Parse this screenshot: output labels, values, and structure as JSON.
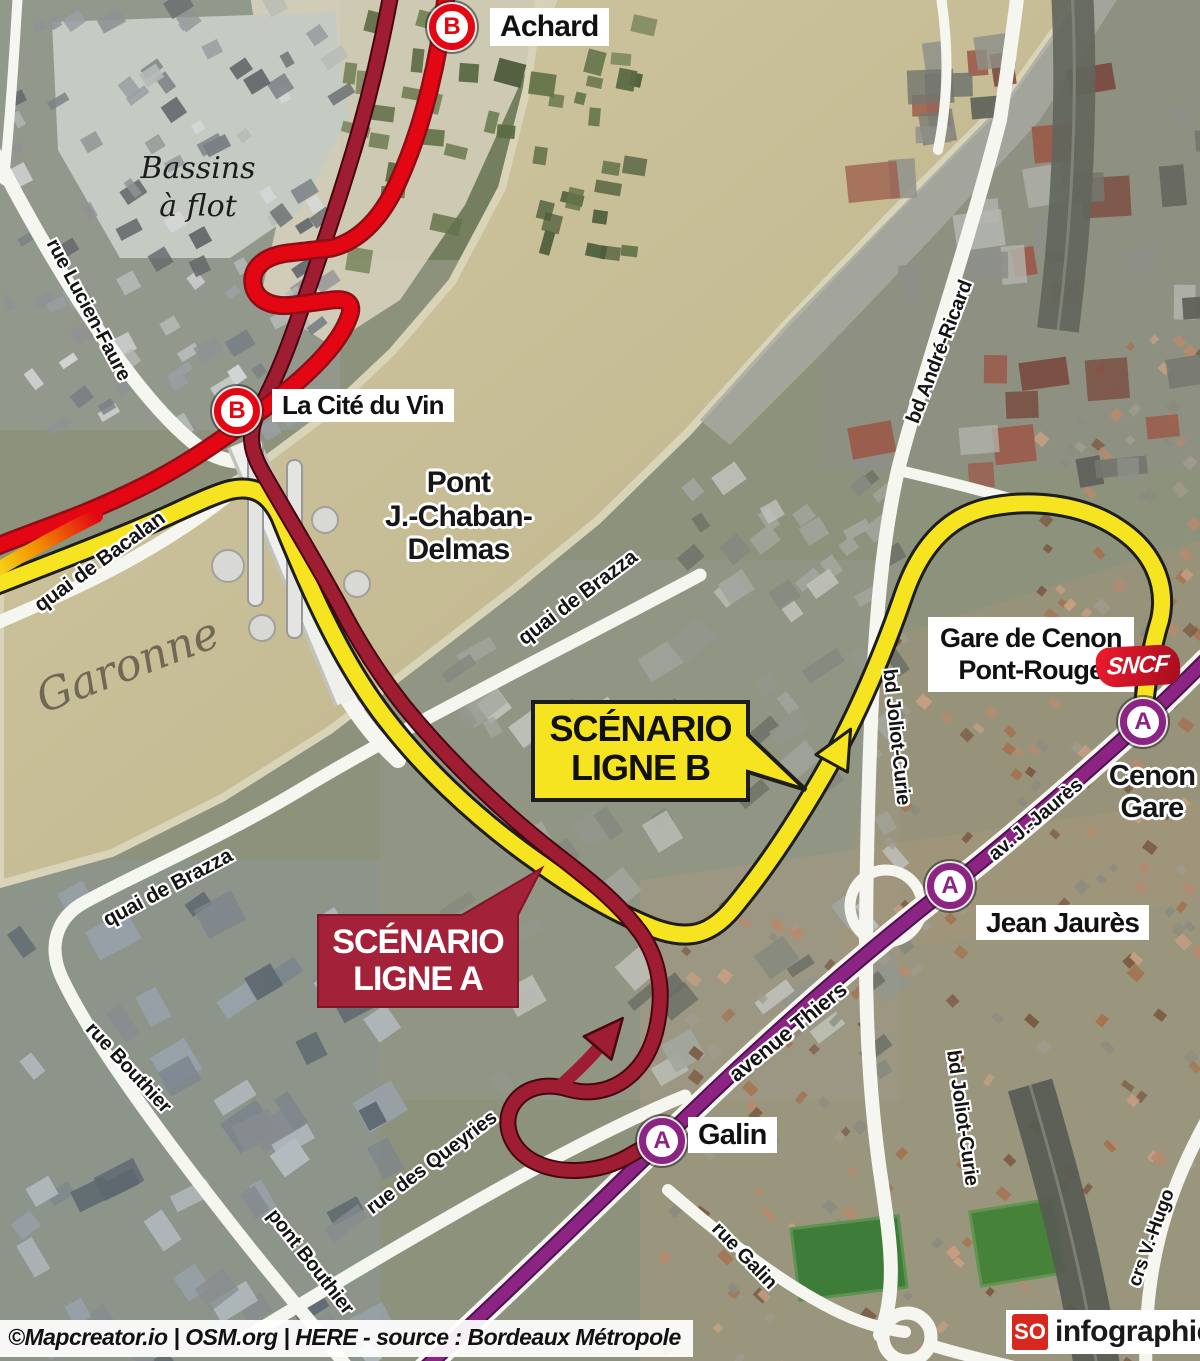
{
  "infographic": {
    "credit": "©Mapcreator.io | OSM.org | HERE - source : Bordeaux Métropole",
    "brand": {
      "so": "SO",
      "label": "infographie"
    },
    "sncf": "SNCF",
    "labels": {
      "river": "Garonne",
      "basins": [
        "Bassins",
        "à flot"
      ],
      "bridge": [
        "Pont",
        "J.-Chaban-",
        "Delmas"
      ],
      "gare_cenon": [
        "Gare de Cenon",
        "Pont-Rouge"
      ],
      "cenon_gare": [
        "Cenon",
        "Gare"
      ]
    },
    "callouts": {
      "ligne_b": {
        "line1": "SCÉNARIO",
        "line2": "LIGNE B"
      },
      "ligne_a": {
        "line1": "SCÉNARIO",
        "line2": "LIGNE A"
      }
    },
    "stations": [
      {
        "line": "B",
        "name": "Achard"
      },
      {
        "line": "B",
        "name": "La Cité du Vin"
      },
      {
        "line": "A",
        "name": "Galin"
      },
      {
        "line": "A",
        "name": "Jean Jaurès"
      },
      {
        "line": "A",
        "name": "Cenon Gare"
      }
    ],
    "streets": [
      "rue Lucien-Faure",
      "quai de Bacalan",
      "quai de Brazza",
      "quai de Brazza",
      "bd André-Ricard",
      "bd Joliot-Curie",
      "bd Joliot-Curie",
      "av. J.-Jaurès",
      "avenue Thiers",
      "rue Bouthier",
      "pont Bouthier",
      "rue des Queyries",
      "rue Galin",
      "crs V.-Hugo"
    ],
    "colors": {
      "line_b_red": "#e30613",
      "scenario_b_yellow": "#f5e41f",
      "scenario_a_maroon": "#9e1d33",
      "line_a_purple": "#8c2483",
      "sncf_red": "#d50f24"
    }
  }
}
